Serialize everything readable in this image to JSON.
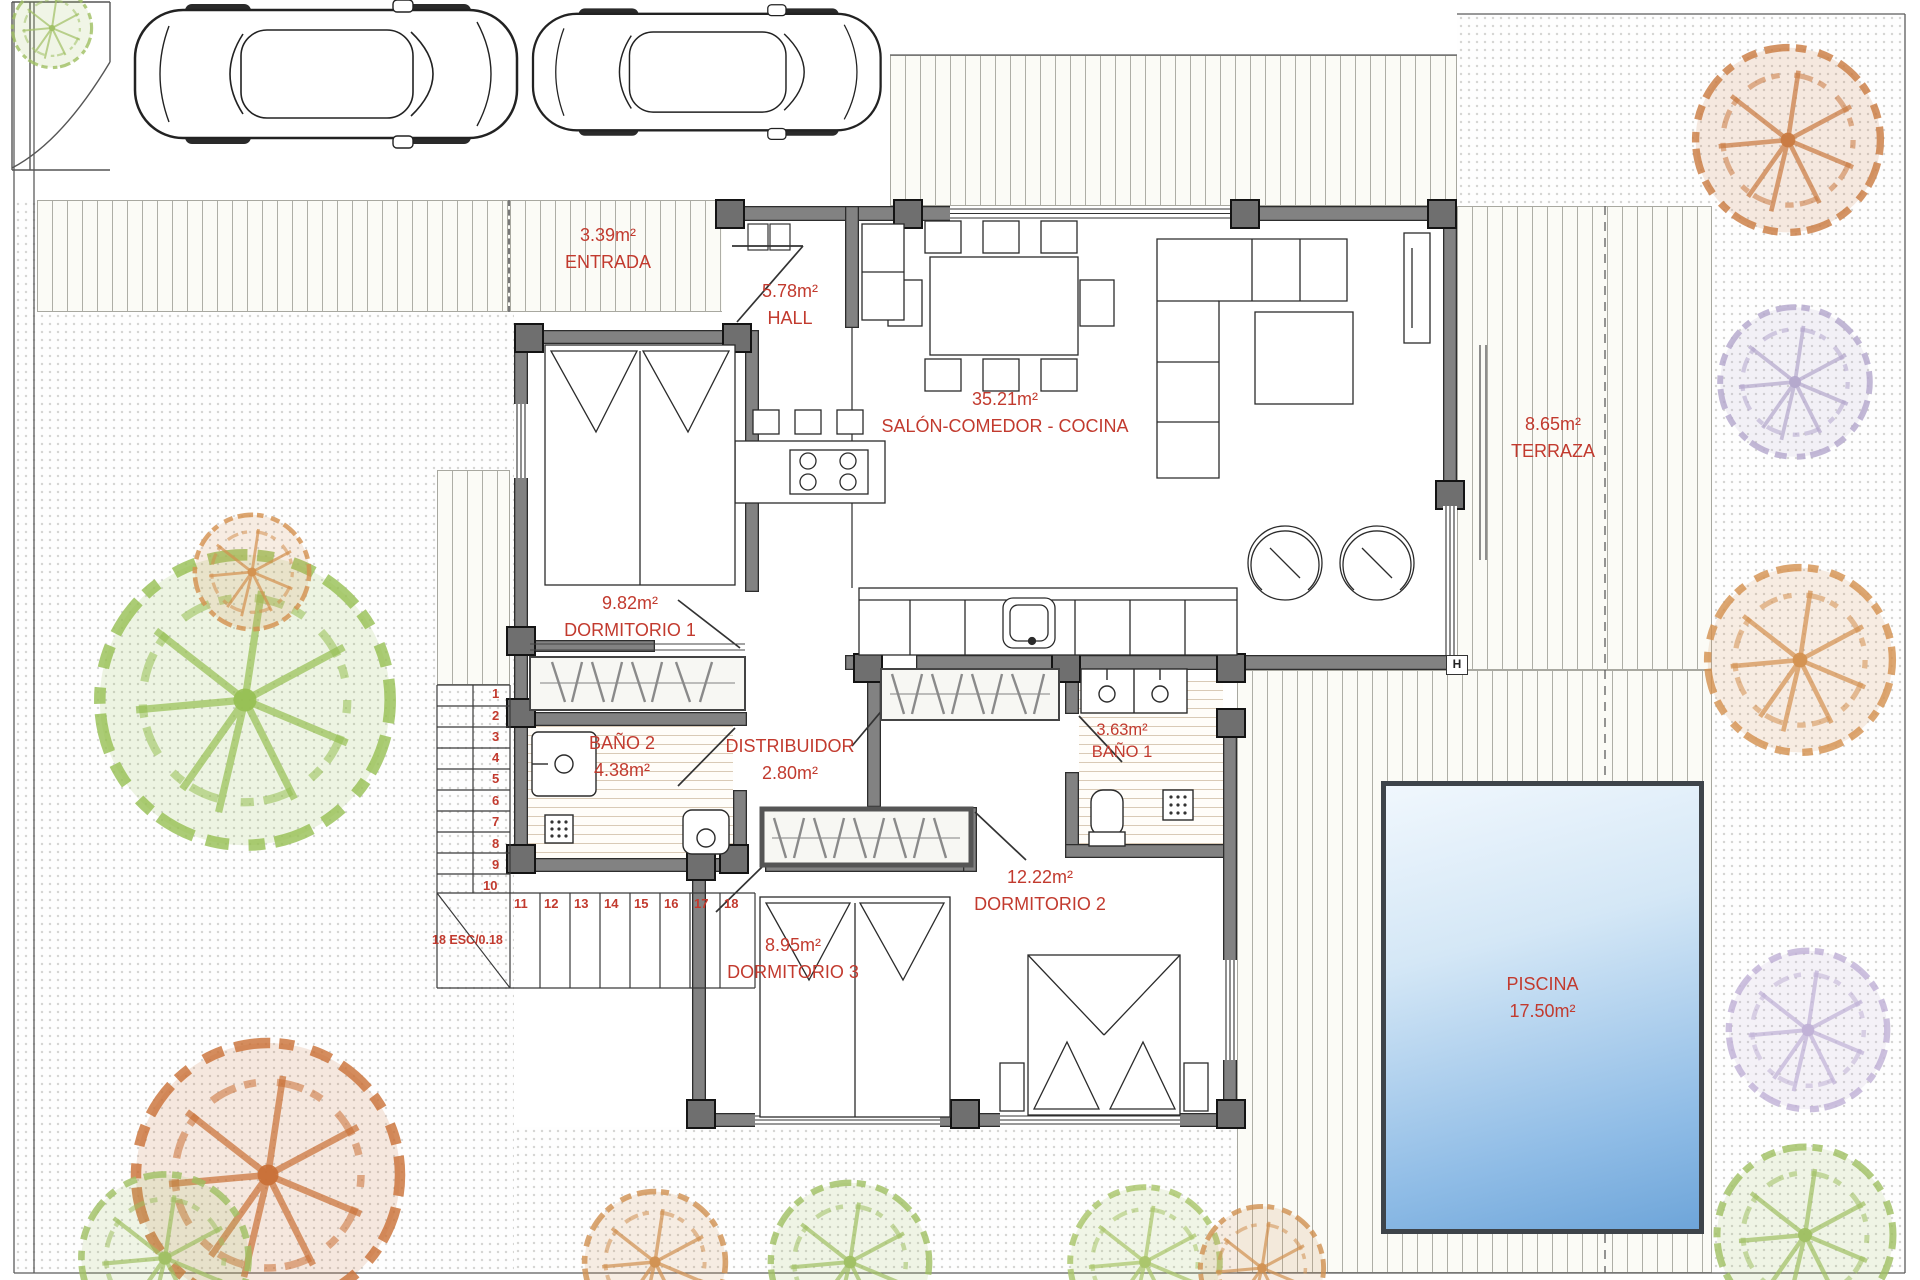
{
  "title": "Villa floor plan",
  "rooms": {
    "entrada": {
      "area": "3.39m²",
      "name": "ENTRADA"
    },
    "hall": {
      "area": "5.78m²",
      "name": "HALL"
    },
    "salon": {
      "area": "35.21m²",
      "name": "SALÓN-COMEDOR - COCINA"
    },
    "terraza": {
      "area": "8.65m²",
      "name": "TERRAZA"
    },
    "dormitorio1": {
      "area": "9.82m²",
      "name": "DORMITORIO 1"
    },
    "bano2": {
      "name": "BAÑO 2",
      "area": "4.38m²"
    },
    "distribuidor": {
      "name": "DISTRIBUIDOR",
      "area": "2.80m²"
    },
    "bano1": {
      "area": "3.63m²",
      "name": "BAÑO 1"
    },
    "dormitorio2": {
      "area": "12.22m²",
      "name": "DORMITORIO 2"
    },
    "dormitorio3": {
      "area": "8.95m²",
      "name": "DORMITORIO 3"
    },
    "piscina": {
      "name": "PISCINA",
      "area": "17.50m²"
    }
  },
  "stairs": {
    "steps": [
      "1",
      "2",
      "3",
      "4",
      "5",
      "6",
      "7",
      "8",
      "9",
      "10",
      "11",
      "12",
      "13",
      "14",
      "15",
      "16",
      "17",
      "18"
    ],
    "label": "18 ESC/0.18"
  },
  "markers": {
    "height": "H"
  },
  "colors": {
    "label_red": "#c23a2e",
    "wall_gray": "#828282",
    "pillar_gray": "#6f6f6f",
    "pool_light": "#f0f7fd",
    "pool_dark": "#6ea5d9",
    "tree_green": "#96bf52",
    "tree_orange": "#d3904e",
    "tree_rust": "#c96f35",
    "tree_purple": "#b7aacd",
    "tile_tan": "#d9cab6"
  }
}
